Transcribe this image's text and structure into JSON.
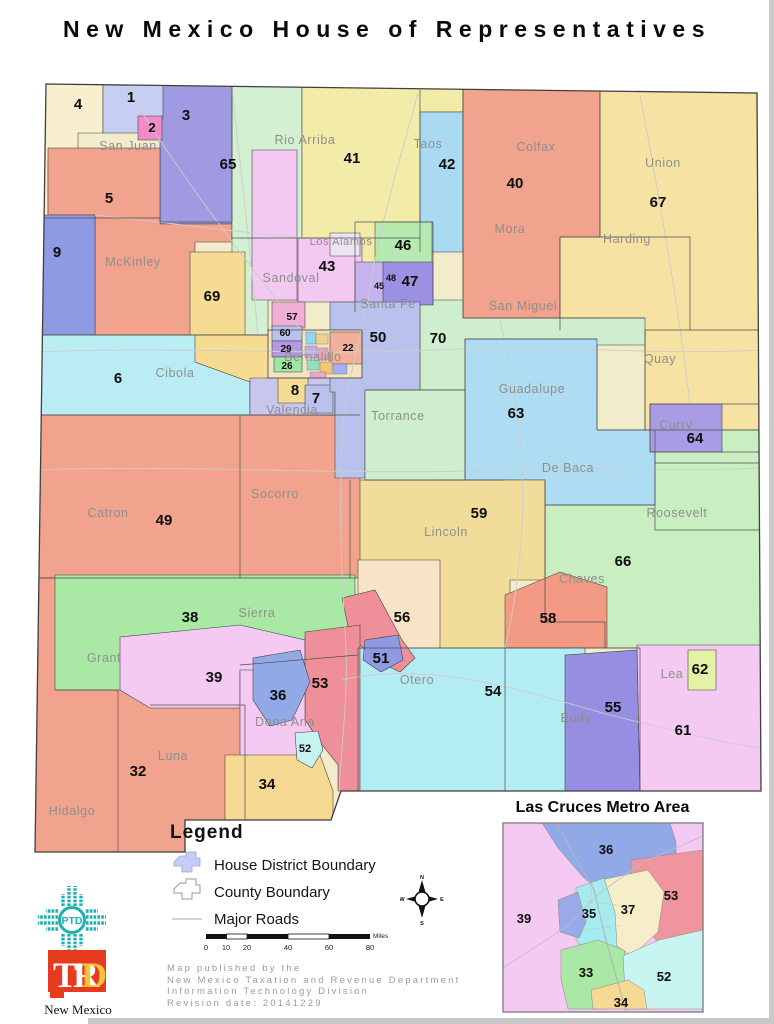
{
  "title": "New Mexico House of Representatives",
  "map": {
    "districts": [
      {
        "n": "4",
        "x": 78,
        "y": 109
      },
      {
        "n": "1",
        "x": 131,
        "y": 102
      },
      {
        "n": "2",
        "x": 152,
        "y": 132,
        "s": 13
      },
      {
        "n": "3",
        "x": 186,
        "y": 120
      },
      {
        "n": "65",
        "x": 228,
        "y": 169
      },
      {
        "n": "41",
        "x": 352,
        "y": 163
      },
      {
        "n": "42",
        "x": 447,
        "y": 169
      },
      {
        "n": "40",
        "x": 515,
        "y": 188
      },
      {
        "n": "67",
        "x": 658,
        "y": 207
      },
      {
        "n": "5",
        "x": 109,
        "y": 203
      },
      {
        "n": "9",
        "x": 57,
        "y": 257
      },
      {
        "n": "69",
        "x": 212,
        "y": 301
      },
      {
        "n": "43",
        "x": 327,
        "y": 271
      },
      {
        "n": "46",
        "x": 403,
        "y": 250
      },
      {
        "n": "45",
        "x": 379,
        "y": 289,
        "s": 9
      },
      {
        "n": "48",
        "x": 391,
        "y": 281,
        "s": 9
      },
      {
        "n": "47",
        "x": 410,
        "y": 286
      },
      {
        "n": "50",
        "x": 378,
        "y": 342
      },
      {
        "n": "70",
        "x": 438,
        "y": 343
      },
      {
        "n": "57",
        "x": 292,
        "y": 320,
        "s": 10
      },
      {
        "n": "60",
        "x": 285,
        "y": 336,
        "s": 10
      },
      {
        "n": "29",
        "x": 286,
        "y": 352,
        "s": 10
      },
      {
        "n": "22",
        "x": 348,
        "y": 351,
        "s": 10
      },
      {
        "n": "26",
        "x": 287,
        "y": 369,
        "s": 10
      },
      {
        "n": "6",
        "x": 118,
        "y": 383
      },
      {
        "n": "8",
        "x": 295,
        "y": 395
      },
      {
        "n": "7",
        "x": 316,
        "y": 403
      },
      {
        "n": "63",
        "x": 516,
        "y": 418
      },
      {
        "n": "64",
        "x": 695,
        "y": 443
      },
      {
        "n": "49",
        "x": 164,
        "y": 525
      },
      {
        "n": "59",
        "x": 479,
        "y": 518
      },
      {
        "n": "66",
        "x": 623,
        "y": 566
      },
      {
        "n": "38",
        "x": 190,
        "y": 622
      },
      {
        "n": "39",
        "x": 214,
        "y": 682
      },
      {
        "n": "56",
        "x": 402,
        "y": 622
      },
      {
        "n": "58",
        "x": 548,
        "y": 623
      },
      {
        "n": "51",
        "x": 381,
        "y": 663
      },
      {
        "n": "36",
        "x": 278,
        "y": 700
      },
      {
        "n": "53",
        "x": 320,
        "y": 688
      },
      {
        "n": "54",
        "x": 493,
        "y": 696
      },
      {
        "n": "55",
        "x": 613,
        "y": 712
      },
      {
        "n": "62",
        "x": 700,
        "y": 674
      },
      {
        "n": "61",
        "x": 683,
        "y": 735
      },
      {
        "n": "32",
        "x": 138,
        "y": 776
      },
      {
        "n": "34",
        "x": 267,
        "y": 789
      },
      {
        "n": "52",
        "x": 305,
        "y": 752,
        "s": 11
      }
    ],
    "counties": [
      {
        "n": "San Juan",
        "x": 128,
        "y": 150
      },
      {
        "n": "Rio Arriba",
        "x": 305,
        "y": 144
      },
      {
        "n": "Taos",
        "x": 428,
        "y": 148
      },
      {
        "n": "Colfax",
        "x": 536,
        "y": 151
      },
      {
        "n": "Union",
        "x": 663,
        "y": 167
      },
      {
        "n": "McKinley",
        "x": 133,
        "y": 266
      },
      {
        "n": "Mora",
        "x": 510,
        "y": 233
      },
      {
        "n": "Harding",
        "x": 627,
        "y": 243
      },
      {
        "n": "Los Alamos",
        "x": 341,
        "y": 245,
        "s": 11
      },
      {
        "n": "Sandoval",
        "x": 291,
        "y": 282
      },
      {
        "n": "Santa Fe",
        "x": 388,
        "y": 308
      },
      {
        "n": "San Miguel",
        "x": 523,
        "y": 310
      },
      {
        "n": "Quay",
        "x": 660,
        "y": 363
      },
      {
        "n": "Cibola",
        "x": 175,
        "y": 377
      },
      {
        "n": "Bernalillo",
        "x": 313,
        "y": 361
      },
      {
        "n": "Valencia",
        "x": 292,
        "y": 414
      },
      {
        "n": "Torrance",
        "x": 398,
        "y": 420
      },
      {
        "n": "Guadalupe",
        "x": 532,
        "y": 393
      },
      {
        "n": "De Baca",
        "x": 568,
        "y": 472
      },
      {
        "n": "Curry",
        "x": 676,
        "y": 429
      },
      {
        "n": "Catron",
        "x": 108,
        "y": 517
      },
      {
        "n": "Socorro",
        "x": 275,
        "y": 498
      },
      {
        "n": "Lincoln",
        "x": 446,
        "y": 536
      },
      {
        "n": "Chaves",
        "x": 582,
        "y": 583
      },
      {
        "n": "Roosevelt",
        "x": 677,
        "y": 517
      },
      {
        "n": "Sierra",
        "x": 257,
        "y": 617
      },
      {
        "n": "Grant",
        "x": 104,
        "y": 662
      },
      {
        "n": "Otero",
        "x": 417,
        "y": 684
      },
      {
        "n": "Eddy",
        "x": 576,
        "y": 722
      },
      {
        "n": "Lea",
        "x": 672,
        "y": 678
      },
      {
        "n": "Dona Ana",
        "x": 285,
        "y": 726
      },
      {
        "n": "Luna",
        "x": 173,
        "y": 760
      },
      {
        "n": "Hidalgo",
        "x": 72,
        "y": 815
      }
    ]
  },
  "legend": {
    "heading": "Legend",
    "items": [
      "House District Boundary",
      "County Boundary",
      "Major Roads"
    ]
  },
  "scalebar": {
    "unit": "Miles",
    "ticks": [
      {
        "n": "0",
        "x": 4,
        "y": 22
      },
      {
        "n": "10",
        "x": 24,
        "y": 22
      },
      {
        "n": "20",
        "x": 45,
        "y": 22
      },
      {
        "n": "40",
        "x": 86,
        "y": 22
      },
      {
        "n": "60",
        "x": 127,
        "y": 22
      },
      {
        "n": "80",
        "x": 168,
        "y": 22
      }
    ]
  },
  "compass": {
    "n": "N",
    "s": "S",
    "e": "E",
    "w": "W"
  },
  "inset": {
    "title": "Las Cruces Metro Area",
    "districts": [
      {
        "n": "36",
        "x": 108,
        "y": 34
      },
      {
        "n": "53",
        "x": 173,
        "y": 80
      },
      {
        "n": "37",
        "x": 130,
        "y": 94
      },
      {
        "n": "35",
        "x": 91,
        "y": 98
      },
      {
        "n": "39",
        "x": 26,
        "y": 103
      },
      {
        "n": "33",
        "x": 88,
        "y": 157
      },
      {
        "n": "52",
        "x": 166,
        "y": 161
      },
      {
        "n": "34",
        "x": 123,
        "y": 187
      }
    ]
  },
  "logos": {
    "ptd": "PTD",
    "trd_main": "TR",
    "trd_accent": "D",
    "trd_caption": "New Mexico"
  },
  "footer": {
    "lines": [
      "Map published by the",
      "New Mexico Taxation and Revenue Department",
      "Information Technology Division",
      "Revision date: 20141229"
    ]
  },
  "colors": {
    "district_boundary": "#3c3c3c",
    "county_boundary": "#4d4d4d",
    "road": "#cccccc",
    "legend_district_fill": "#c3cdf5",
    "ptd_teal": "#1fb0b0",
    "trd_red": "#e63b1e",
    "trd_yellow": "#f6c33c"
  }
}
